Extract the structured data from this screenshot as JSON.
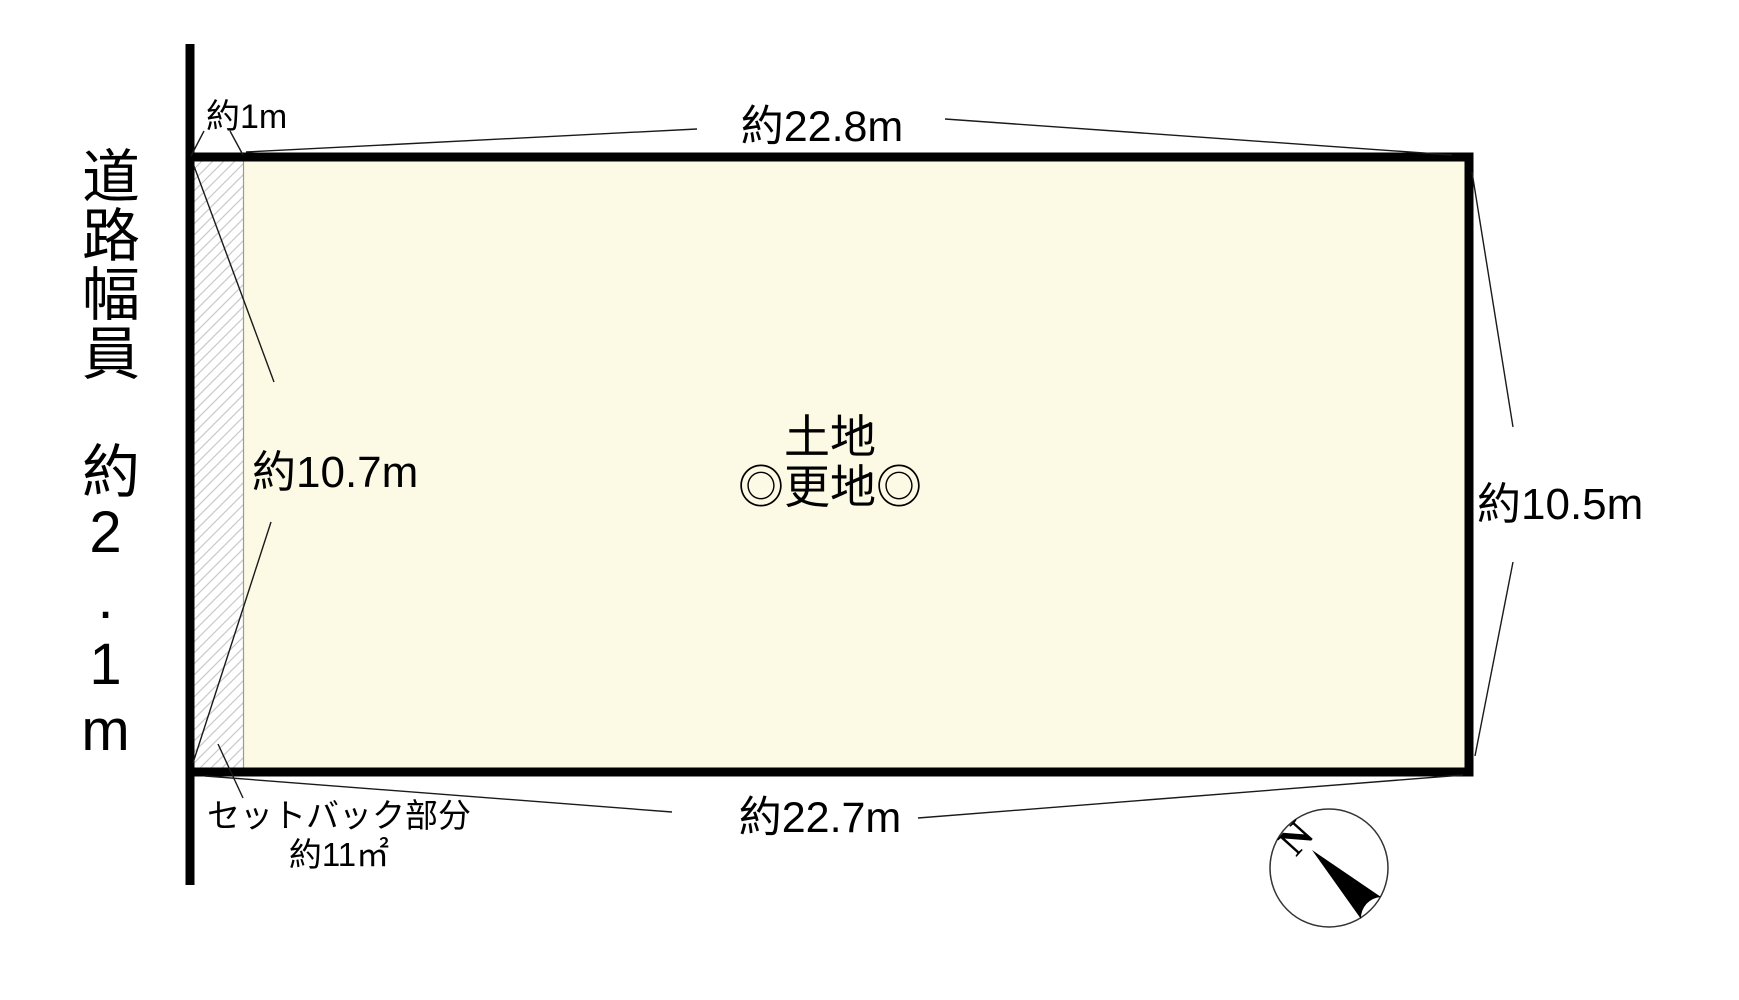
{
  "road": {
    "label": "道路幅員　約2.1m"
  },
  "plot": {
    "label_line1": "土地",
    "label_line2": "◎更地◎"
  },
  "dimensions": {
    "top": "約22.8m",
    "bottom": "約22.7m",
    "right": "約10.5m",
    "left_inner": "約10.7m",
    "setback_offset": "約1m"
  },
  "setback": {
    "line1": "セットバック部分",
    "line2": "約11㎡"
  },
  "compass": {
    "north": "N"
  },
  "colors": {
    "plot_fill": "#FCFAE4",
    "hatch": "#C9C9C9",
    "outline": "#000000",
    "leader": "#1A1A1A"
  }
}
